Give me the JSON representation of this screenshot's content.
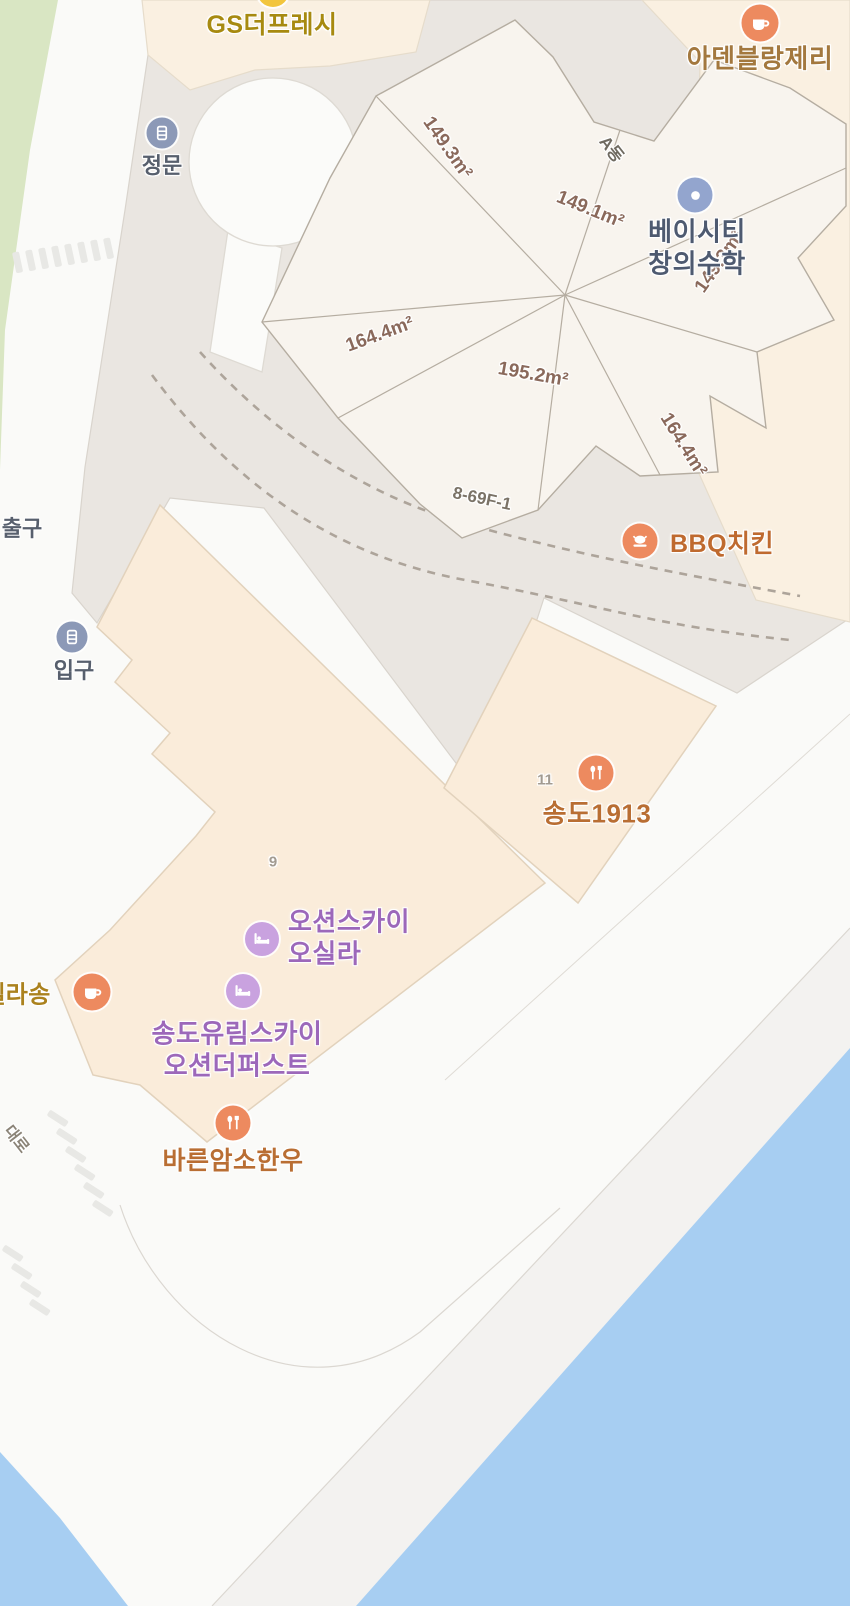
{
  "pois": {
    "gs": {
      "label": "GS더프레시"
    },
    "aden": {
      "label": "아덴블랑제리"
    },
    "jeongmun": {
      "label": "정문"
    },
    "chulgu": {
      "label": "출구"
    },
    "ipgu": {
      "label": "입구"
    },
    "baycity": {
      "line1": "베이시티",
      "line2": "창의수학"
    },
    "bbq": {
      "label": "BBQ치킨"
    },
    "songdo1913": {
      "label": "송도1913"
    },
    "oceansky": {
      "line1": "오션스카이",
      "line2": "오실라"
    },
    "yurim": {
      "line1": "송도유림스카이",
      "line2": "오션더퍼스트"
    },
    "dellasong": {
      "label": "델라송"
    },
    "bareun": {
      "label": "바른암소한우"
    }
  },
  "areas": [
    "149.3m²",
    "149.1m²",
    "149.3m²",
    "164.4m²",
    "195.2m²",
    "164.4m²"
  ],
  "parcel": {
    "block_label": "A동",
    "lot_label": "8-69F-1"
  },
  "numbers": {
    "building9": "9",
    "building11": "11"
  },
  "roads": {
    "daero": "대로"
  },
  "colors": {
    "water": "#A7CEF2",
    "park_green": "#D9E6C3",
    "plaza_gray": "#EAE6E1",
    "building_peach": "#FAF0E1",
    "building_beige": "#FAECDA",
    "parcel_fill": "#F8F4EE",
    "parcel_line": "#B5ADA1",
    "poi_orange": "#ED8A5F",
    "poi_purple": "#C9A2DF",
    "poi_blue": "#8C99B7",
    "poi_edu_blue": "#93A5CE",
    "poi_yellow": "#F2C53D",
    "label_food": "#B96E33",
    "label_hotel": "#9C68BA",
    "label_academy": "#4E5A70",
    "label_gate": "#575F6D",
    "label_area": "#8A695B"
  }
}
